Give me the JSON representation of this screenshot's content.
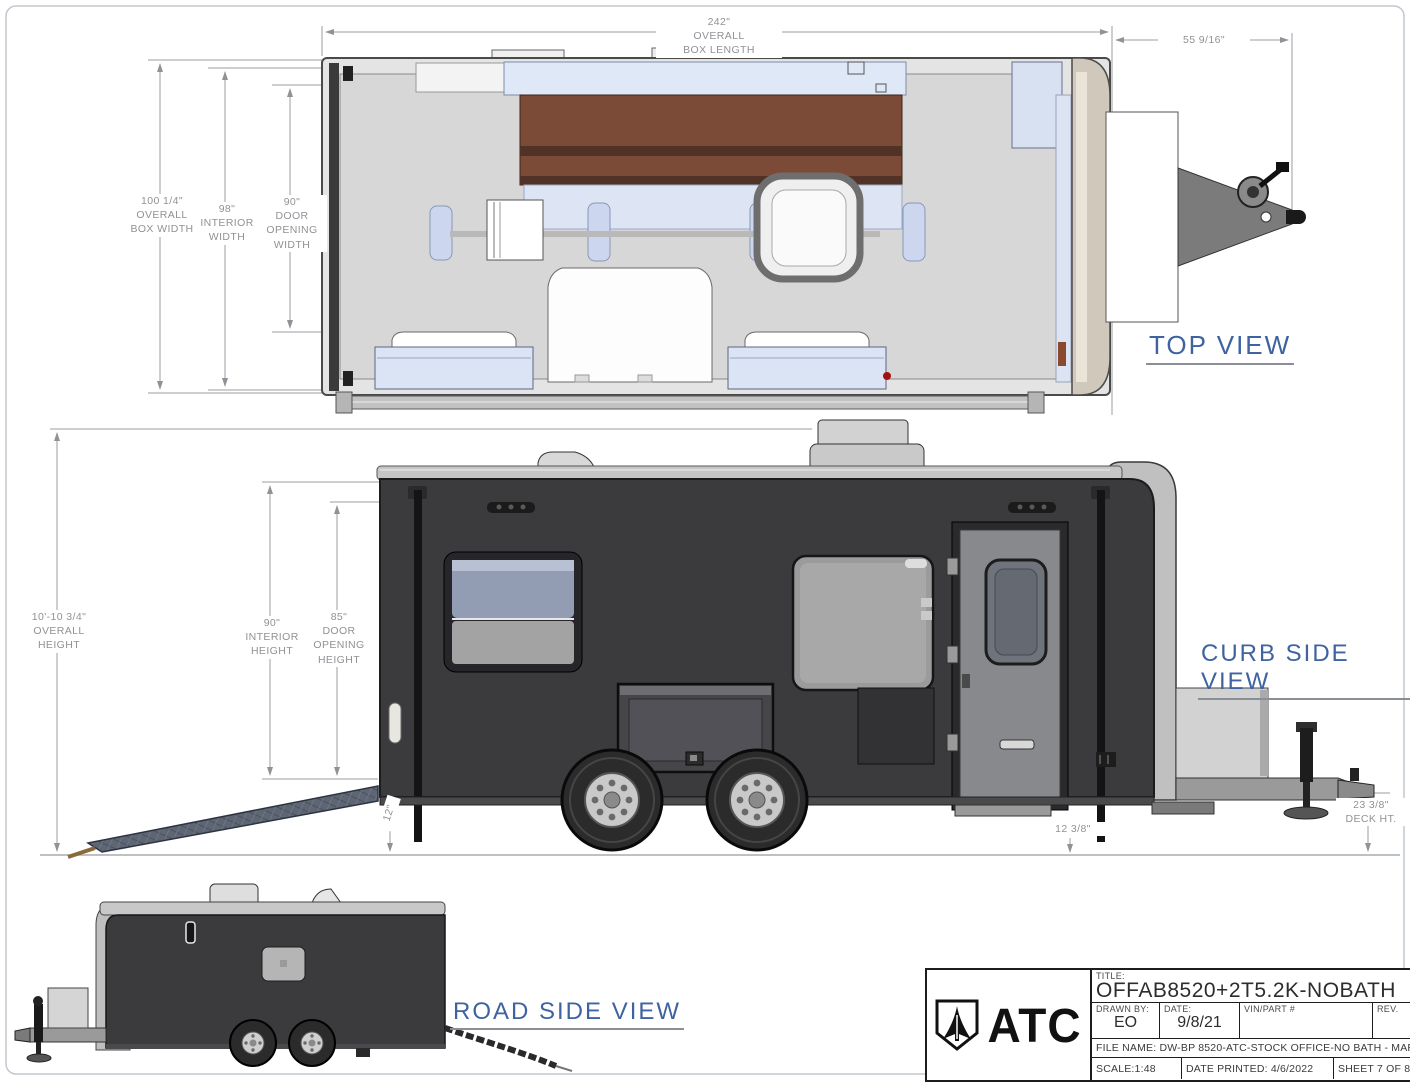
{
  "views": {
    "top_label": "TOP VIEW",
    "curb_label": "CURB SIDE VIEW",
    "road_label": "ROAD SIDE VIEW"
  },
  "dims": {
    "box_length": "242\"\nOVERALL\nBOX LENGTH",
    "tongue_length": "55 9/16\"",
    "overall_box_width": "100 1/4\"\nOVERALL\nBOX WIDTH",
    "interior_width": "98\"\nINTERIOR\nWIDTH",
    "door_opening_width": "90\"\nDOOR\nOPENING\nWIDTH",
    "overall_height": "10'-10 3/4\"\nOVERALL\nHEIGHT",
    "interior_height": "90\"\nINTERIOR\nHEIGHT",
    "door_opening_height": "85\"\nDOOR\nOPENING\nHEIGHT",
    "ramp_rise": "12\"",
    "step_clearance": "12 3/8\"",
    "deck_height": "23 3/8\"\nDECK HT."
  },
  "title_block": {
    "logo_text": "ATC",
    "title_label": "TITLE:",
    "title_value": "OFFAB8520+2T5.2K-NOBATH",
    "drawn_by_label": "DRAWN BY:",
    "drawn_by_value": "EO",
    "date_label": "DATE:",
    "date_value": "9/8/21",
    "vin_label": "VIN/PART #",
    "rev_label": "REV.",
    "file_name": "FILE NAME: DW-BP 8520-ATC-STOCK OFFICE-NO BATH - MARKET",
    "scale": "SCALE:1:48",
    "date_printed": "DATE PRINTED: 4/6/2022",
    "sheet": "SHEET 7 OF 8"
  },
  "colors": {
    "body_dark": "#3b3b3d",
    "view_label_blue": "#3e63a0",
    "dim_text_gray": "#8f9296",
    "sofa_brown": "#7b4b37",
    "accent_light_blue": "#d9e2f4",
    "cap_beige": "#cfc8bb",
    "floor_gray": "#d7d7d7"
  }
}
